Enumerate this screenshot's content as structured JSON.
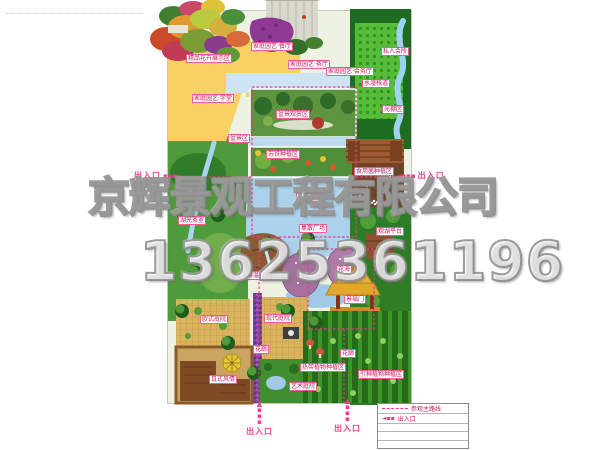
{
  "watermark": {
    "company": "京辉景观工程有限公司",
    "phone": "13625361196"
  },
  "legend": {
    "route_label": "参观主路线",
    "entrance_label": "出入口",
    "empty_rows": 3
  },
  "entrances": [
    {
      "id": "left",
      "label": "出入口",
      "x": 134,
      "y": 170,
      "direction": "right"
    },
    {
      "id": "right",
      "label": "出入口",
      "x": 396,
      "y": 170,
      "direction": "left"
    },
    {
      "id": "bottom-left",
      "label": "出入口",
      "x": 246,
      "y": 401,
      "direction": "up"
    },
    {
      "id": "bottom-right",
      "label": "出入口",
      "x": 334,
      "y": 398,
      "direction": "up"
    }
  ],
  "colors": {
    "route_pink": "#ea3b86",
    "entrance_pink": "#f23b8c",
    "label_border": "#ef5a9a",
    "label_text": "#c2185b",
    "watermark_gray": "#8a8a8a",
    "water_blue": "#abd2ea",
    "forest_green": "#1e6b22",
    "lawn_green": "#5c9440",
    "yellow_zone": "#f7d263",
    "courtyard_tan": "#d9b35e",
    "dome_purple": "#a4719c"
  },
  "map": {
    "labels": [
      {
        "text": "精品花卉展示区",
        "x": 18,
        "y": 43
      },
      {
        "text": "家庭园艺·餐厅",
        "x": 83,
        "y": 31
      },
      {
        "text": "家庭园艺·茶厅",
        "x": 120,
        "y": 49
      },
      {
        "text": "家庭园艺·会务厅",
        "x": 158,
        "y": 56
      },
      {
        "text": "私人会所",
        "x": 213,
        "y": 36
      },
      {
        "text": "水漫栈道",
        "x": 194,
        "y": 68
      },
      {
        "text": "家庭园艺·学堂",
        "x": 24,
        "y": 83
      },
      {
        "text": "光棚区",
        "x": 214,
        "y": 94
      },
      {
        "text": "盆景区",
        "x": 60,
        "y": 123
      },
      {
        "text": "盆景观赏区",
        "x": 108,
        "y": 99
      },
      {
        "text": "苏铁种植区",
        "x": 98,
        "y": 139
      },
      {
        "text": "食用菌种植区",
        "x": 186,
        "y": 156
      },
      {
        "text": "怡人景苑",
        "x": 128,
        "y": 182
      },
      {
        "text": "集散广场",
        "x": 131,
        "y": 213
      },
      {
        "text": "观湖平台",
        "x": 208,
        "y": 216
      },
      {
        "text": "湖光茶室",
        "x": 10,
        "y": 205
      },
      {
        "text": "组培温室",
        "x": 71,
        "y": 260
      },
      {
        "text": "花海",
        "x": 168,
        "y": 254
      },
      {
        "text": "景福门",
        "x": 176,
        "y": 284
      },
      {
        "text": "欧式庭院",
        "x": 32,
        "y": 304
      },
      {
        "text": "现代庭院",
        "x": 96,
        "y": 303
      },
      {
        "text": "花廊",
        "x": 85,
        "y": 334
      },
      {
        "text": "花廊",
        "x": 172,
        "y": 338
      },
      {
        "text": "日式风情",
        "x": 41,
        "y": 364
      },
      {
        "text": "艺术庭院",
        "x": 121,
        "y": 371
      },
      {
        "text": "热带植物种植区",
        "x": 132,
        "y": 352
      },
      {
        "text": "引种植物种植区",
        "x": 190,
        "y": 359
      }
    ]
  }
}
